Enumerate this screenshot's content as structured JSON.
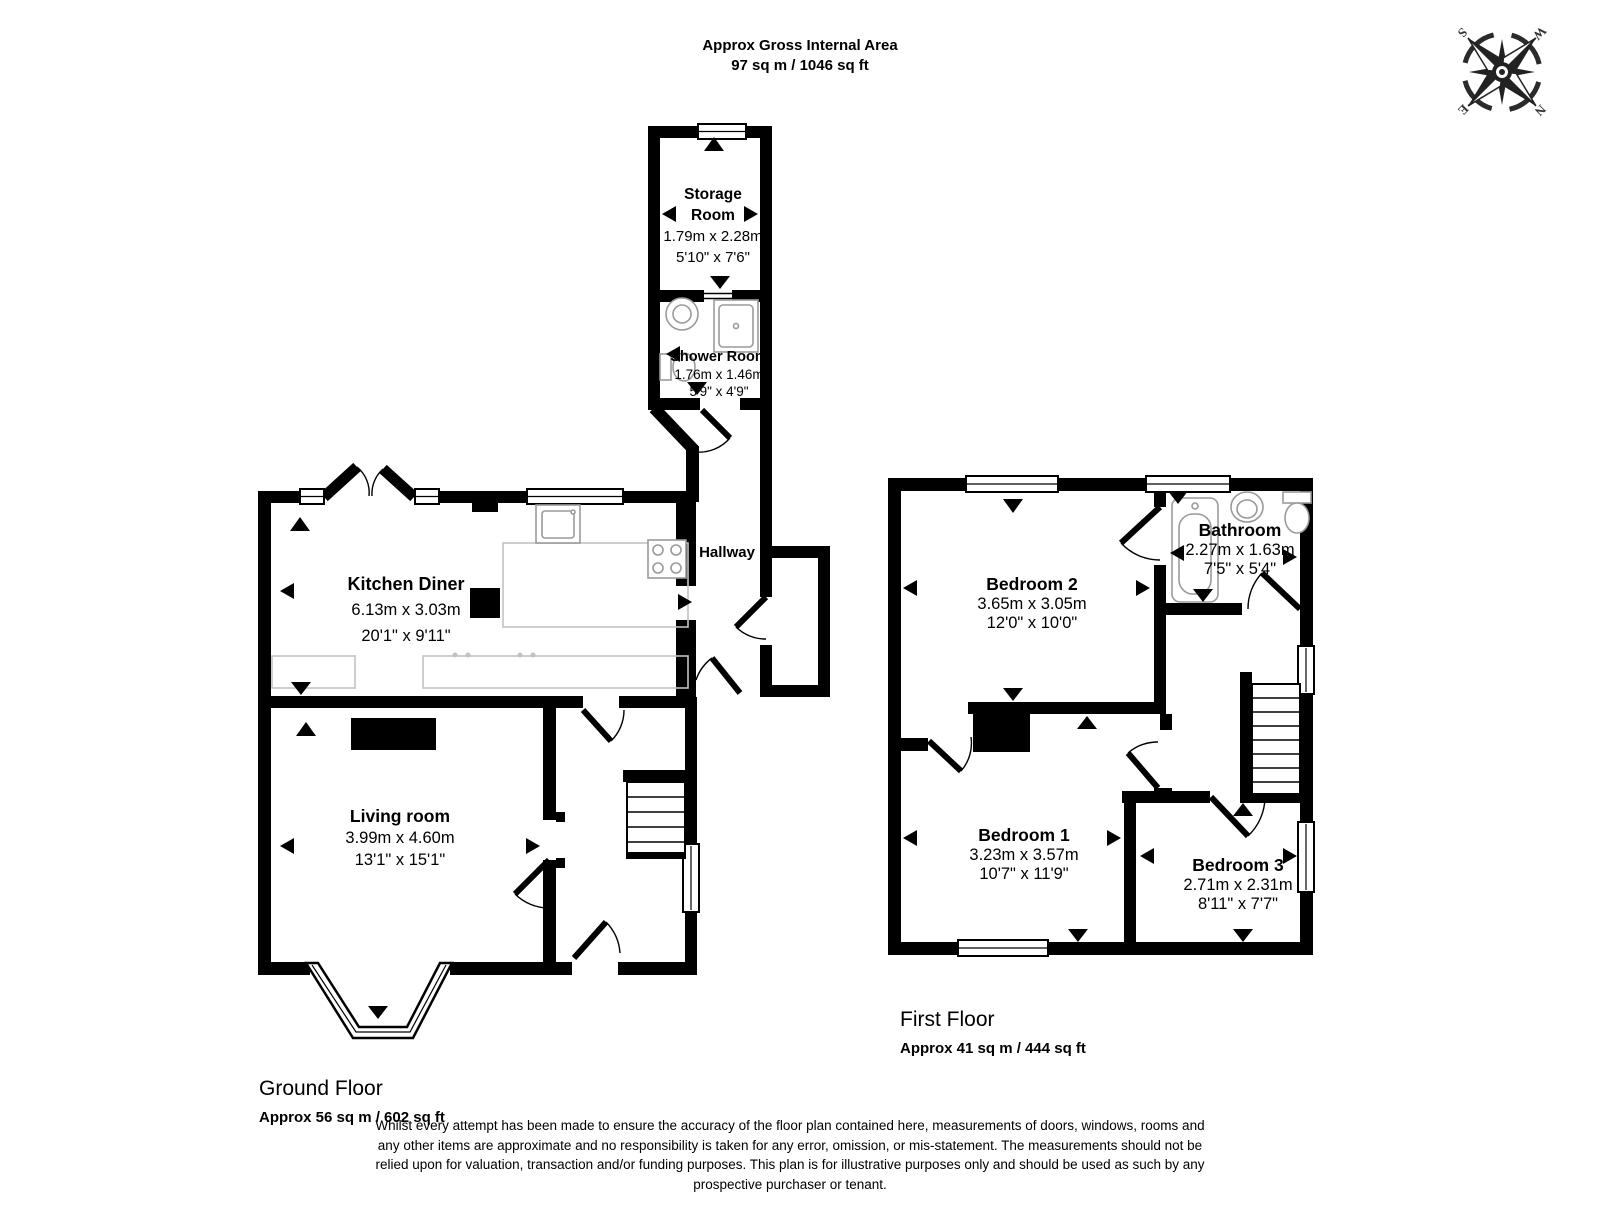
{
  "header": {
    "title": "Approx Gross Internal Area",
    "area": "97 sq m / 1046 sq ft"
  },
  "compass": {
    "n": "N",
    "e": "E",
    "s": "S",
    "w": "W"
  },
  "ground_floor": {
    "title": "Ground Floor",
    "area": "Approx 56 sq m / 602 sq ft",
    "rooms": {
      "storage": {
        "name": "Storage Room",
        "metric": "1.79m x 2.28m",
        "imperial": "5'10\" x 7'6\""
      },
      "shower": {
        "name": "Shower Room",
        "metric": "1.76m x 1.46m",
        "imperial": "5'9\" x 4'9\""
      },
      "kitchen": {
        "name": "Kitchen Diner",
        "metric": "6.13m x 3.03m",
        "imperial": "20'1\" x 9'11\""
      },
      "hallway": {
        "name": "Hallway"
      },
      "living": {
        "name": "Living room",
        "metric": "3.99m x 4.60m",
        "imperial": "13'1\" x 15'1\""
      }
    }
  },
  "first_floor": {
    "title": "First Floor",
    "area": "Approx 41 sq m / 444 sq ft",
    "rooms": {
      "bedroom2": {
        "name": "Bedroom 2",
        "metric": "3.65m x 3.05m",
        "imperial": "12'0\" x 10'0\""
      },
      "bathroom": {
        "name": "Bathroom",
        "metric": "2.27m x 1.63m",
        "imperial": "7'5\" x 5'4\""
      },
      "bedroom1": {
        "name": "Bedroom 1",
        "metric": "3.23m x 3.57m",
        "imperial": "10'7\" x 11'9\""
      },
      "bedroom3": {
        "name": "Bedroom 3",
        "metric": "2.71m x 2.31m",
        "imperial": "8'11\" x 7'7\""
      }
    }
  },
  "disclaimer": "Whilst every attempt has been made to ensure the accuracy of the floor plan contained here, measurements of doors, windows, rooms and any other items are approximate and no responsibility is taken for any error, omission, or mis-statement. The measurements should not be relied upon for valuation, transaction and/or funding purposes. This plan is for illustrative purposes only and should be used as such by any prospective purchaser or tenant."
}
